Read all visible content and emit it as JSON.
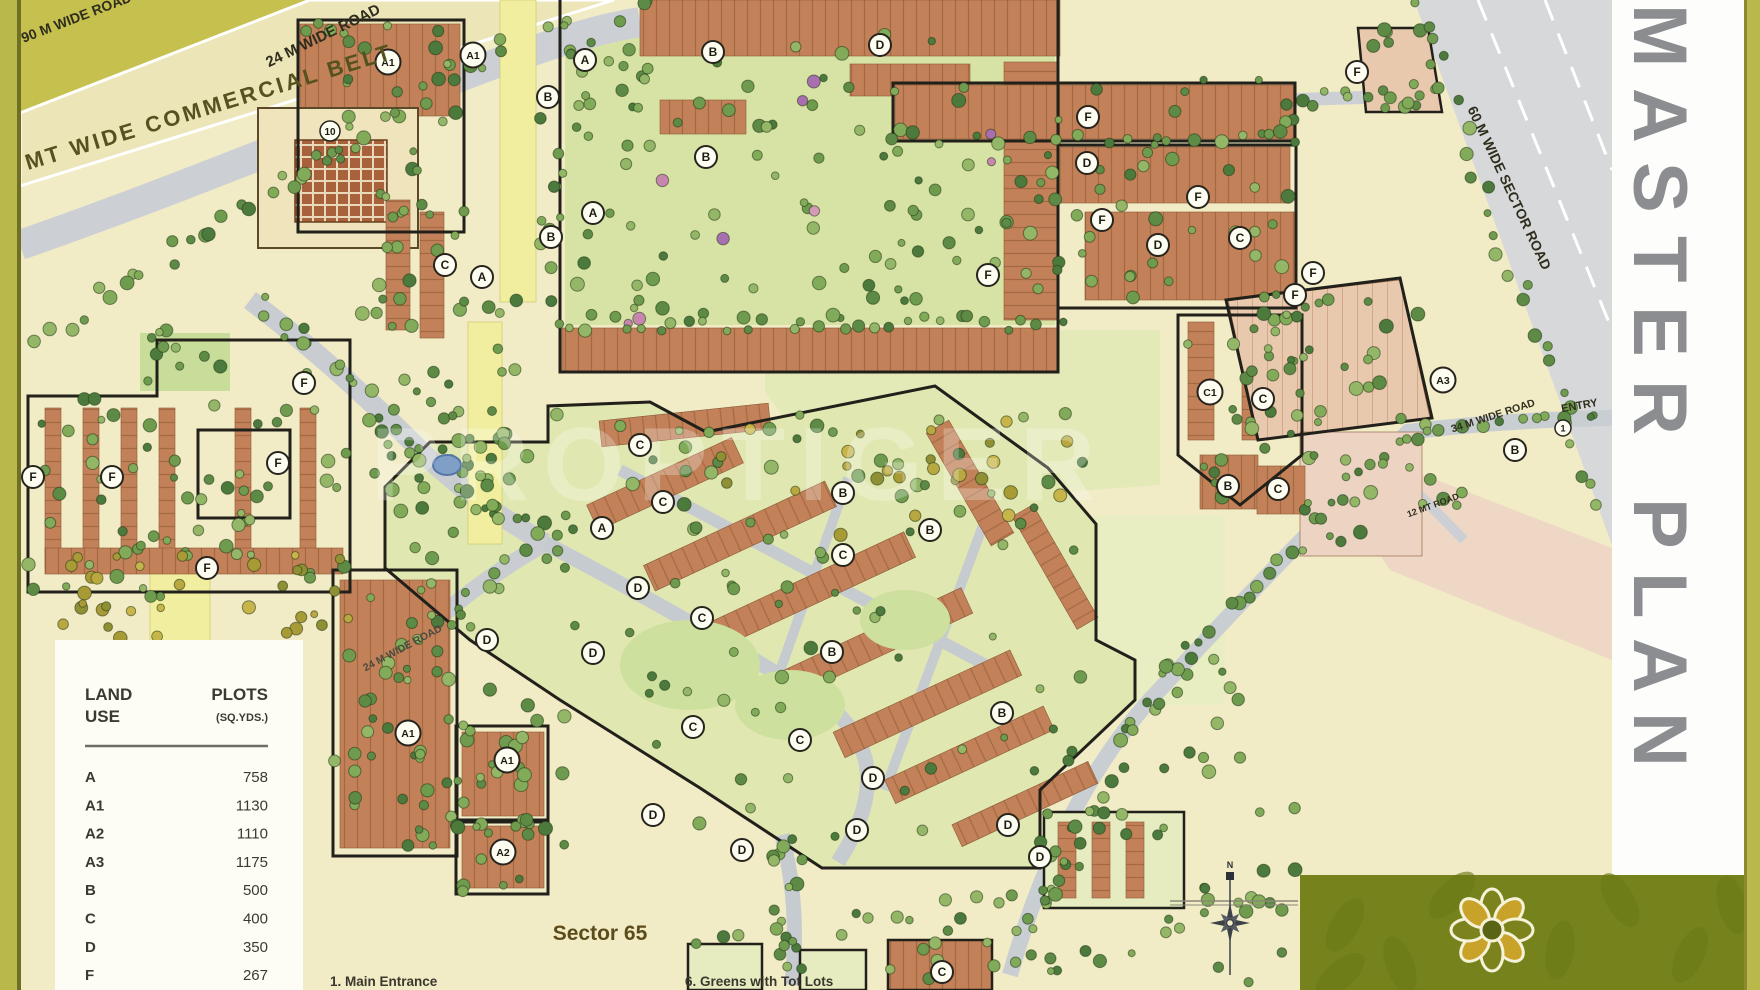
{
  "title": {
    "text": "MASTER PLAN"
  },
  "watermark": "PROPTIGER",
  "sector_label": "Sector 65",
  "compass": {
    "label": "N"
  },
  "entry": {
    "label": "ENTRY",
    "number": "1"
  },
  "community_block_number": "10",
  "legend": {
    "col1_line1": "LAND",
    "col1_line2": "USE",
    "col2_line1": "PLOTS",
    "col2_line2": "(SQ.YDS.)",
    "rows": [
      {
        "use": "A",
        "plot": "758"
      },
      {
        "use": "A1",
        "plot": "1130"
      },
      {
        "use": "A2",
        "plot": "1110"
      },
      {
        "use": "A3",
        "plot": "1175"
      },
      {
        "use": "B",
        "plot": "500"
      },
      {
        "use": "C",
        "plot": "400"
      },
      {
        "use": "D",
        "plot": "350"
      },
      {
        "use": "F",
        "plot": "267"
      }
    ]
  },
  "notes": [
    {
      "num": "1.",
      "text": "Main Entrance"
    },
    {
      "num": "6.",
      "text": "Greens with Tot Lots"
    }
  ],
  "road_labels": [
    {
      "text": "90 M WIDE ROAD",
      "x": 78,
      "y": 22,
      "rot": -21,
      "size": 14,
      "cls": "road-label"
    },
    {
      "text": "200 MT  WIDE  COMMERCIAL  BELT",
      "x": 185,
      "y": 122,
      "rot": -17,
      "size": 22,
      "cls": "belt-label"
    },
    {
      "text": "24 M  WIDE ROAD",
      "x": 325,
      "y": 40,
      "rot": -26,
      "size": 15,
      "cls": "road-label"
    },
    {
      "text": "60 M WIDE SECTOR ROAD",
      "x": 1505,
      "y": 190,
      "rot": 65,
      "size": 14,
      "cls": "road-label"
    },
    {
      "text": "34 M WIDE ROAD",
      "x": 1494,
      "y": 419,
      "rot": -18,
      "size": 10.5,
      "cls": "road-label"
    },
    {
      "text": "ENTRY",
      "x": 1580,
      "y": 409,
      "rot": -10,
      "size": 11,
      "cls": "road-label"
    },
    {
      "text": "12 MT ROAD",
      "x": 1434,
      "y": 508,
      "rot": -20,
      "size": 9,
      "cls": "road-label"
    },
    {
      "text": "24 M WIDE ROAD",
      "x": 404,
      "y": 651,
      "rot": -28,
      "size": 10.5,
      "cls": "mid-label"
    }
  ],
  "markers": [
    {
      "t": "A1",
      "x": 388,
      "y": 62
    },
    {
      "t": "A1",
      "x": 473,
      "y": 55
    },
    {
      "t": "A",
      "x": 585,
      "y": 60
    },
    {
      "t": "B",
      "x": 713,
      "y": 52
    },
    {
      "t": "D",
      "x": 880,
      "y": 45
    },
    {
      "t": "B",
      "x": 548,
      "y": 97
    },
    {
      "t": "B",
      "x": 706,
      "y": 157
    },
    {
      "t": "A",
      "x": 593,
      "y": 213
    },
    {
      "t": "B",
      "x": 551,
      "y": 237
    },
    {
      "t": "C",
      "x": 445,
      "y": 265
    },
    {
      "t": "A",
      "x": 482,
      "y": 277
    },
    {
      "t": "F",
      "x": 304,
      "y": 383
    },
    {
      "t": "F",
      "x": 33,
      "y": 477
    },
    {
      "t": "F",
      "x": 112,
      "y": 477
    },
    {
      "t": "F",
      "x": 278,
      "y": 463
    },
    {
      "t": "F",
      "x": 207,
      "y": 568
    },
    {
      "t": "F",
      "x": 988,
      "y": 275
    },
    {
      "t": "F",
      "x": 1088,
      "y": 117
    },
    {
      "t": "D",
      "x": 1087,
      "y": 163
    },
    {
      "t": "F",
      "x": 1198,
      "y": 197
    },
    {
      "t": "F",
      "x": 1102,
      "y": 220
    },
    {
      "t": "D",
      "x": 1158,
      "y": 245
    },
    {
      "t": "C",
      "x": 1240,
      "y": 238
    },
    {
      "t": "F",
      "x": 1313,
      "y": 273
    },
    {
      "t": "F",
      "x": 1357,
      "y": 72
    },
    {
      "t": "F",
      "x": 1295,
      "y": 295
    },
    {
      "t": "C1",
      "x": 1210,
      "y": 392
    },
    {
      "t": "C",
      "x": 1263,
      "y": 399
    },
    {
      "t": "A3",
      "x": 1443,
      "y": 380
    },
    {
      "t": "B",
      "x": 1515,
      "y": 450
    },
    {
      "t": "B",
      "x": 1228,
      "y": 486
    },
    {
      "t": "C",
      "x": 1278,
      "y": 489
    },
    {
      "t": "C",
      "x": 640,
      "y": 445
    },
    {
      "t": "C",
      "x": 663,
      "y": 502
    },
    {
      "t": "A",
      "x": 602,
      "y": 528
    },
    {
      "t": "B",
      "x": 843,
      "y": 493
    },
    {
      "t": "B",
      "x": 930,
      "y": 530
    },
    {
      "t": "C",
      "x": 843,
      "y": 555
    },
    {
      "t": "D",
      "x": 638,
      "y": 588
    },
    {
      "t": "C",
      "x": 702,
      "y": 618
    },
    {
      "t": "D",
      "x": 593,
      "y": 653
    },
    {
      "t": "B",
      "x": 832,
      "y": 652
    },
    {
      "t": "C",
      "x": 693,
      "y": 727
    },
    {
      "t": "C",
      "x": 800,
      "y": 740
    },
    {
      "t": "B",
      "x": 1002,
      "y": 713
    },
    {
      "t": "D",
      "x": 873,
      "y": 778
    },
    {
      "t": "D",
      "x": 487,
      "y": 640
    },
    {
      "t": "A1",
      "x": 408,
      "y": 733
    },
    {
      "t": "A1",
      "x": 507,
      "y": 760
    },
    {
      "t": "A2",
      "x": 503,
      "y": 852
    },
    {
      "t": "D",
      "x": 653,
      "y": 815
    },
    {
      "t": "D",
      "x": 742,
      "y": 850
    },
    {
      "t": "D",
      "x": 857,
      "y": 830
    },
    {
      "t": "D",
      "x": 1008,
      "y": 825
    },
    {
      "t": "D",
      "x": 1040,
      "y": 857
    },
    {
      "t": "C",
      "x": 942,
      "y": 972
    }
  ],
  "colors": {
    "background": "#f1ebc6",
    "road": "#ccd0d4",
    "block_terracotta": "#c28158",
    "park_green": "#d7e3a4",
    "page_border": "#b9b84b",
    "logo_panel": "#76831d",
    "title_gray": "#8b8d90"
  }
}
